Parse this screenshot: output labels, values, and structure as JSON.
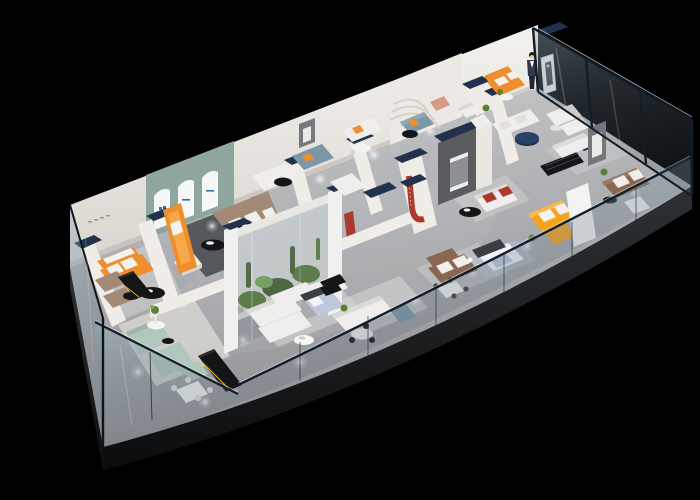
{
  "scene": {
    "type": "isometric-cutaway-floorplan-render",
    "setting": "furniture showroom interior",
    "background": "black",
    "view": "aerial oblique from south-east",
    "rooms": [
      "striped-sofa-room",
      "arched-display-room",
      "terrarium-display",
      "sage-lounge",
      "dining-area",
      "white-modular-lounge",
      "center-feature-lounge",
      "bedroom-display-blue",
      "bedroom-display-white",
      "yellow-sofa-room",
      "reception-room-with-hostess",
      "glazed-side-rooms"
    ],
    "furniture": [
      "orange-striped-sofa",
      "taupe-l-sofa",
      "orange-chaise",
      "sage-sofa-set",
      "black-kitchen-island",
      "white-modular-sofa",
      "steel-blue-sofa",
      "brown-leather-sofa",
      "yellow-l-sofa",
      "red-accent-sofa",
      "display-bed",
      "glass-dining-table",
      "round-pedestal-table",
      "navy-round-table",
      "black-coffee-table",
      "white-armchair",
      "louvered-console",
      "hostess-figure"
    ],
    "features": [
      "glass-perimeter-walls",
      "navy-wall-caps",
      "arched-niches-with-logos",
      "cactus-terrarium",
      "red-ribbon-wall-decor",
      "ceiling-spotlights"
    ]
  },
  "colors": {
    "background": "#000000",
    "floor_hi": "#c9cbcc",
    "floor_lo": "#8e9093",
    "slab": "#26282b",
    "wall_white": "#f0ede8",
    "wall_shade": "#d9d5cf",
    "navy_cap": "#22324d",
    "glass_frame": "#131d2a",
    "glass_tint": "#7e95a5",
    "glass_hilite": "#dfeaf2",
    "arch_wall_teal": "#8fa69e",
    "arch_white": "#f6f8f7",
    "logo_blue": "#2f6db5",
    "sofa_orange": "#ee8e2d",
    "sofa_yellow": "#f4a31d",
    "sofa_taupe": "#a28a76",
    "sofa_brown": "#8a6750",
    "sofa_sage": "#b0c7bb",
    "sofa_steel": "#7c97a8",
    "sofa_white": "#efeeec",
    "chair_salmon": "#d89a82",
    "accent_red": "#ab3a2d",
    "bed_blue": "#bcc9dc",
    "black_furniture": "#141517",
    "gold_trim": "#d8a52f",
    "plant_green": "#5d8038",
    "plant_dark": "#47632e",
    "plant_light": "#7fae55",
    "navy_table": "#1d2f4e",
    "feature_gray": "#595b5e",
    "rug_dark": "#4b4e52",
    "rug_light": "#d4d4d3",
    "skin": "#e8c9b0",
    "suit_navy": "#2b3850"
  }
}
